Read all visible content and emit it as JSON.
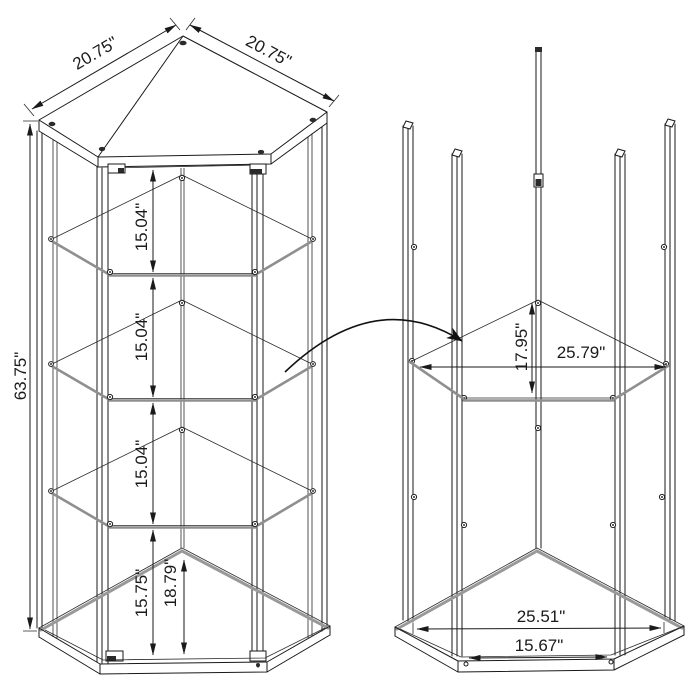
{
  "diagram": {
    "kind": "furniture dimension line drawing",
    "subject": "corner curio display cabinet with glass shelves",
    "colors": {
      "line": "#1a1a1a",
      "glass_edge": "#8f8f8f",
      "background": "#ffffff"
    },
    "views": {
      "cabinet": {
        "label": "assembled cabinet front view",
        "dims": {
          "top_edge_left": "20.75\"",
          "top_edge_right": "20.75\"",
          "height": "63.75\"",
          "gap1": "15.04\"",
          "gap2": "15.04\"",
          "gap3": "15.04\"",
          "gap_bottom": "15.75\"",
          "floor_depth": "18.79\""
        }
      },
      "frame": {
        "label": "frame and glass shelf detail view",
        "dims": {
          "shelf_depth": "17.95\"",
          "shelf_width": "25.79\"",
          "base_outer_width": "25.51\"",
          "base_inner_width": "15.67\""
        }
      }
    },
    "annotation": {
      "arrow": "curved arrow from cabinet shelf to detail-view shelf"
    }
  }
}
